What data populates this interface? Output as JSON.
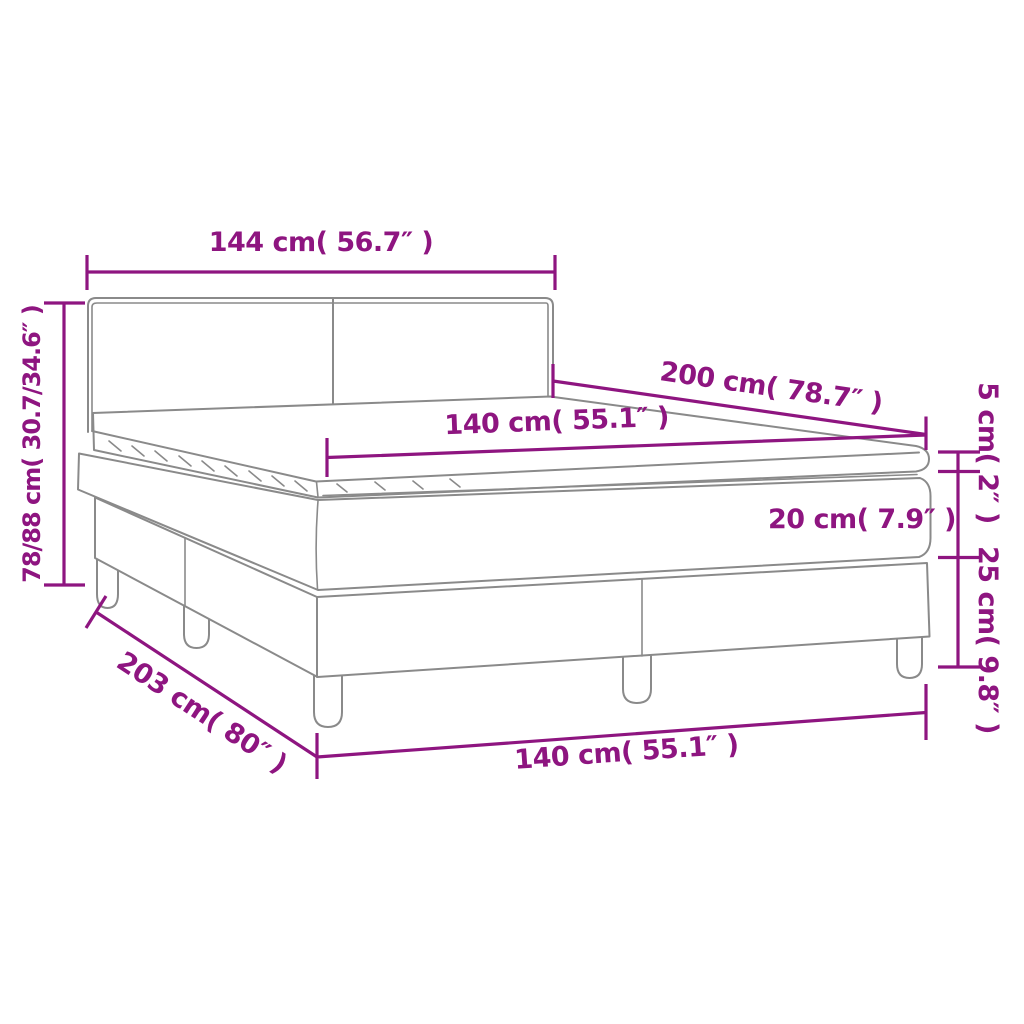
{
  "diagram": {
    "type": "bed-dimension-diagram",
    "background": "#ffffff",
    "accent_color": "#8E1580",
    "line_color": "#8a8a8a",
    "labels": {
      "headboard_width": "144 cm( 56.7″ )",
      "total_height": "78/88 cm( 30.7/34.6″ )",
      "mattress_length": "200 cm( 78.7″ )",
      "mattress_width": "140 cm( 55.1″ )",
      "topper_height": "5 cm( 2″ )",
      "mattress_height": "20 cm( 7.9″ )",
      "base_height": "25 cm( 9.8″ )",
      "base_length": "203 cm( 80″ )",
      "base_width": "140 cm( 55.1″ )"
    }
  }
}
